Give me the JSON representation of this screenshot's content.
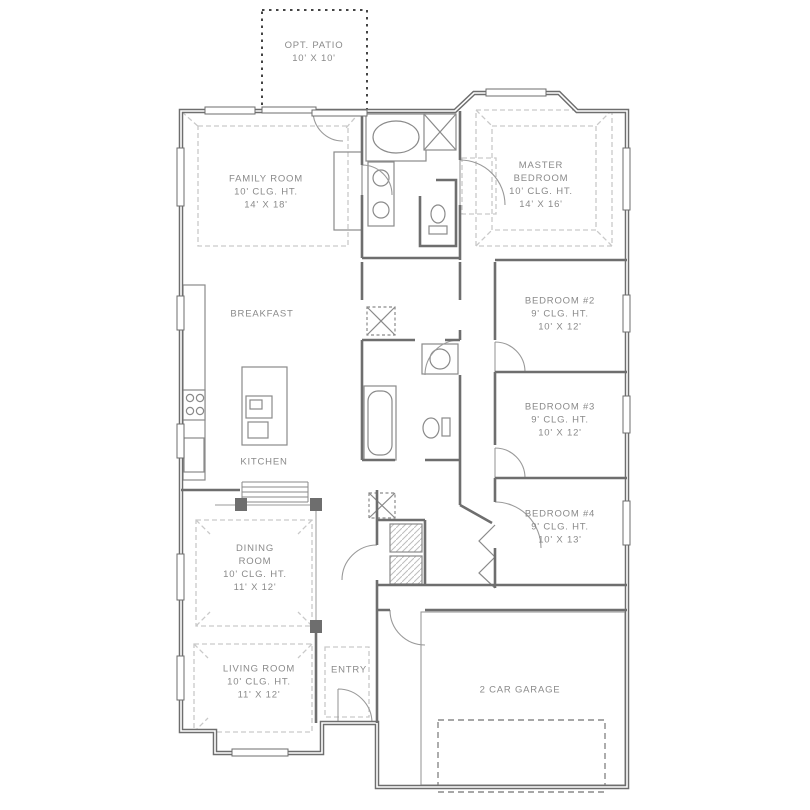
{
  "plan": {
    "type": "single-story house floor plan",
    "colors": {
      "background": "#ffffff",
      "wall": "#6e6e6e",
      "fixture": "#8a8a8a",
      "tray_dash": "#c9c9c9",
      "label": "#8a8a8a",
      "patio_dotted": "#444444"
    }
  },
  "rooms": {
    "opt_patio": {
      "lines": [
        "OPT. PATIO",
        "10' X 10'"
      ]
    },
    "family": {
      "lines": [
        "FAMILY ROOM",
        "10' CLG. HT.",
        "14' X 18'"
      ]
    },
    "master": {
      "lines": [
        "MASTER",
        "BEDROOM",
        "10' CLG. HT.",
        "14' X 16'"
      ]
    },
    "breakfast": {
      "lines": [
        "BREAKFAST"
      ]
    },
    "kitchen": {
      "lines": [
        "KITCHEN"
      ]
    },
    "bedroom2": {
      "lines": [
        "BEDROOM #2",
        "9' CLG. HT.",
        "10' X 12'"
      ]
    },
    "bedroom3": {
      "lines": [
        "BEDROOM #3",
        "9' CLG. HT.",
        "10' X 12'"
      ]
    },
    "bedroom4": {
      "lines": [
        "BEDROOM #4",
        "9' CLG. HT.",
        "10' X 13'"
      ]
    },
    "dining": {
      "lines": [
        "DINING",
        "ROOM",
        "10' CLG. HT.",
        "11' X 12'"
      ]
    },
    "living": {
      "lines": [
        "LIVING ROOM",
        "10' CLG. HT.",
        "11' X 12'"
      ]
    },
    "entry": {
      "lines": [
        "ENTRY"
      ]
    },
    "garage": {
      "lines": [
        "2 CAR GARAGE"
      ]
    }
  }
}
